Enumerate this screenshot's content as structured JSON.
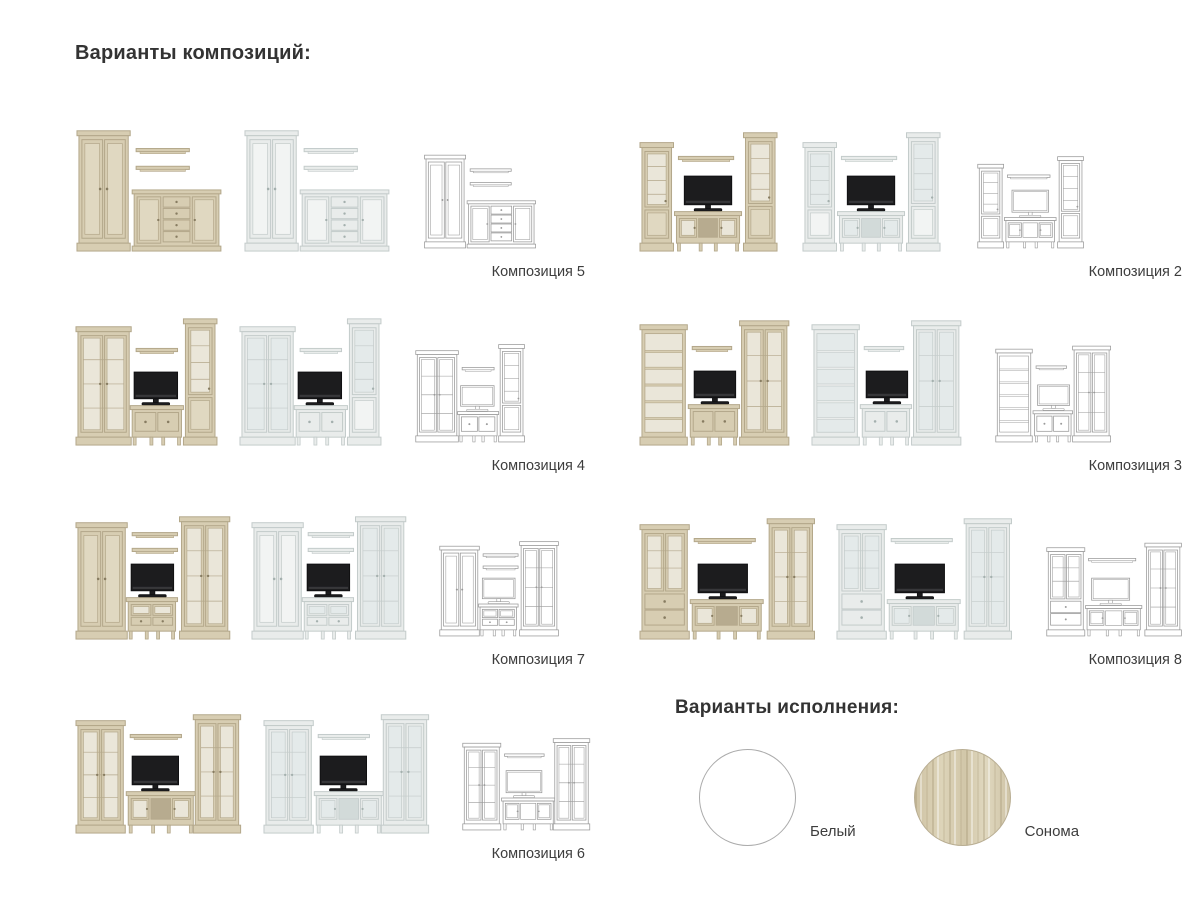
{
  "page": {
    "compositions_title": "Варианты композиций:",
    "finishes_title": "Варианты исполнения:"
  },
  "palette": {
    "text": "#3d3d3d",
    "heading": "#333333",
    "variants": {
      "sonoma": {
        "body": "#d7cdb2",
        "edge": "#b3a78a",
        "panel": "#e0d8c1",
        "glass": "#eae6d9",
        "knob": "#877c61",
        "open": "#b7ab8f",
        "tv": "#1c1c1e"
      },
      "white": {
        "body": "#e9eceb",
        "edge": "#c3cbca",
        "panel": "#f2f4f3",
        "glass": "#e4eaea",
        "knob": "#a4b0ae",
        "open": "#d2dad9",
        "tv": "#1c1c1e"
      },
      "wireframe": {
        "body": "#ffffff",
        "edge": "#9a9a9a",
        "panel": "#ffffff",
        "glass": "#ffffff",
        "knob": "#9a9a9a",
        "open": "#ffffff",
        "tv": "#ffffff"
      }
    }
  },
  "variants": [
    "sonoma",
    "white",
    "wireframe"
  ],
  "compositions": [
    {
      "label": "Композиция 5",
      "side": "left",
      "vb": 150,
      "pieces": [
        {
          "t": "cab",
          "kind": "solid",
          "x": 4,
          "y": 16,
          "w": 50,
          "h": 122
        },
        {
          "t": "shelf",
          "x": 62,
          "y": 34,
          "w": 54
        },
        {
          "t": "shelf",
          "x": 62,
          "y": 52,
          "w": 54
        },
        {
          "t": "sideboard",
          "x": 60,
          "y": 76,
          "w": 86,
          "h": 62
        }
      ]
    },
    {
      "label": "Композиция 4",
      "side": "left",
      "vb": 146,
      "pieces": [
        {
          "t": "cab",
          "kind": "glass",
          "x": 3,
          "y": 18,
          "w": 52,
          "h": 120
        },
        {
          "t": "shelf",
          "x": 62,
          "y": 40,
          "w": 42
        },
        {
          "t": "tv",
          "x": 60,
          "y": 64,
          "w": 44,
          "h": 27
        },
        {
          "t": "tvstand",
          "kind": "stand2d",
          "x": 58,
          "y": 98,
          "w": 50,
          "h": 40
        },
        {
          "t": "cab",
          "kind": "tower",
          "x": 112,
          "y": 10,
          "w": 30,
          "h": 128
        }
      ]
    },
    {
      "label": "Композиция 7",
      "side": "left",
      "vb": 158,
      "pieces": [
        {
          "t": "cab",
          "kind": "solid",
          "x": 3,
          "y": 20,
          "w": 48,
          "h": 118
        },
        {
          "t": "shelf",
          "x": 58,
          "y": 30,
          "w": 46
        },
        {
          "t": "shelf",
          "x": 58,
          "y": 46,
          "w": 46
        },
        {
          "t": "tv",
          "x": 57,
          "y": 62,
          "w": 43,
          "h": 27
        },
        {
          "t": "tvstand",
          "kind": "standdd",
          "x": 54,
          "y": 96,
          "w": 48,
          "h": 42
        },
        {
          "t": "cab",
          "kind": "glass",
          "x": 108,
          "y": 14,
          "w": 47,
          "h": 124
        }
      ]
    },
    {
      "label": "Композиция 6",
      "side": "left",
      "vb": 170,
      "pieces": [
        {
          "t": "cab",
          "kind": "glass",
          "x": 3,
          "y": 24,
          "w": 46,
          "h": 114
        },
        {
          "t": "shelf",
          "x": 56,
          "y": 38,
          "w": 52
        },
        {
          "t": "tv",
          "x": 58,
          "y": 60,
          "w": 47,
          "h": 29
        },
        {
          "t": "tvstand",
          "kind": "stand3",
          "x": 54,
          "y": 96,
          "w": 66,
          "h": 42
        },
        {
          "t": "cab",
          "kind": "glass",
          "x": 122,
          "y": 18,
          "w": 44,
          "h": 120
        }
      ]
    },
    {
      "label": "Композиция 2",
      "side": "right",
      "vb": 145,
      "pieces": [
        {
          "t": "cab",
          "kind": "tower",
          "x": 3,
          "y": 28,
          "w": 30,
          "h": 110
        },
        {
          "t": "shelf",
          "x": 40,
          "y": 42,
          "w": 56
        },
        {
          "t": "tv",
          "x": 46,
          "y": 62,
          "w": 48,
          "h": 29
        },
        {
          "t": "tvstand",
          "kind": "stand3",
          "x": 38,
          "y": 98,
          "w": 64,
          "h": 40
        },
        {
          "t": "cab",
          "kind": "tower",
          "x": 108,
          "y": 18,
          "w": 30,
          "h": 120
        }
      ]
    },
    {
      "label": "Композиция 3",
      "side": "right",
      "vb": 154,
      "pieces": [
        {
          "t": "cab",
          "kind": "open",
          "x": 3,
          "y": 16,
          "w": 44,
          "h": 122
        },
        {
          "t": "shelf",
          "x": 54,
          "y": 38,
          "w": 40
        },
        {
          "t": "tv",
          "x": 56,
          "y": 63,
          "w": 42,
          "h": 27
        },
        {
          "t": "tvstand",
          "kind": "stand2d",
          "x": 52,
          "y": 97,
          "w": 48,
          "h": 41
        },
        {
          "t": "cab",
          "kind": "glass",
          "x": 104,
          "y": 12,
          "w": 46,
          "h": 126
        }
      ]
    },
    {
      "label": "Композиция 8",
      "side": "right",
      "vb": 180,
      "pieces": [
        {
          "t": "cab",
          "kind": "glassdrawer",
          "x": 3,
          "y": 22,
          "w": 46,
          "h": 116
        },
        {
          "t": "shelf",
          "x": 56,
          "y": 36,
          "w": 62
        },
        {
          "t": "tv",
          "x": 60,
          "y": 62,
          "w": 50,
          "h": 29
        },
        {
          "t": "tvstand",
          "kind": "stand3",
          "x": 54,
          "y": 98,
          "w": 70,
          "h": 40
        },
        {
          "t": "cab",
          "kind": "glass",
          "x": 132,
          "y": 16,
          "w": 44,
          "h": 122
        }
      ]
    }
  ],
  "finishes": [
    {
      "label": "Белый",
      "swatch": "white"
    },
    {
      "label": "Сонома",
      "swatch": "sonoma"
    }
  ]
}
